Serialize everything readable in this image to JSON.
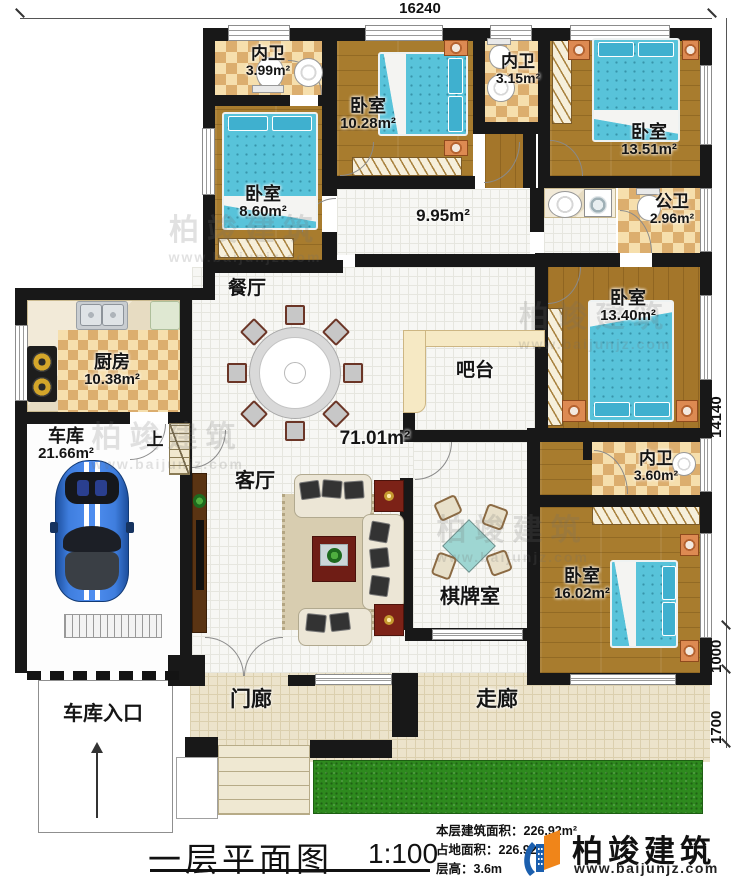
{
  "dims": {
    "top": "16240",
    "right_main": "14140",
    "right_mid": "1000",
    "right_low": "1700"
  },
  "rooms": {
    "bath1": {
      "name": "内卫",
      "area": "3.99m²"
    },
    "bed1": {
      "name": "卧室",
      "area": "10.28m²"
    },
    "bath2": {
      "name": "内卫",
      "area": "3.15m²"
    },
    "bed2": {
      "name": "卧室",
      "area": "13.51m²"
    },
    "bed3": {
      "name": "卧室",
      "area": "8.60m²"
    },
    "pub_bath": {
      "name": "公卫",
      "area": "2.96m²"
    },
    "kitchen": {
      "name": "厨房",
      "area": "10.38m²"
    },
    "bed4": {
      "name": "卧室",
      "area": "13.40m²"
    },
    "garage": {
      "name": "车库",
      "area": "21.66m²"
    },
    "bath3": {
      "name": "内卫",
      "area": "3.60m²"
    },
    "bed5": {
      "name": "卧室",
      "area": "16.02m²"
    },
    "dining": {
      "name": "餐厅"
    },
    "bar": {
      "name": "吧台"
    },
    "living": {
      "name": "客厅"
    },
    "chess": {
      "name": "棋牌室"
    },
    "stairs": {
      "name": "上"
    },
    "porch": {
      "name": "门廊"
    },
    "walkway": {
      "name": "走廊"
    },
    "garage_entry": {
      "name": "车库入口"
    }
  },
  "areas": {
    "corridor": "9.95m²",
    "hall": "71.01m²"
  },
  "title_block": {
    "title": "一层平面图",
    "scale": "1:100",
    "s1l": "本层建筑面积：",
    "s1v": "226.92m²",
    "s2l": "占地面积：",
    "s2v": "226.92m²",
    "s3l": "层高：",
    "s3v": "3.6m"
  },
  "brand": {
    "name": "柏竣建筑",
    "site": "www.baijunjz.com"
  },
  "watermark": {
    "name": "柏竣建筑",
    "site": "www.baijunjz.com"
  },
  "colors": {
    "wall": "#181818",
    "bed_blue": "#58c3da",
    "lawn_green": "#2e8a1e",
    "brand_blue": "#1b5fae",
    "brand_orange": "#f08519"
  }
}
